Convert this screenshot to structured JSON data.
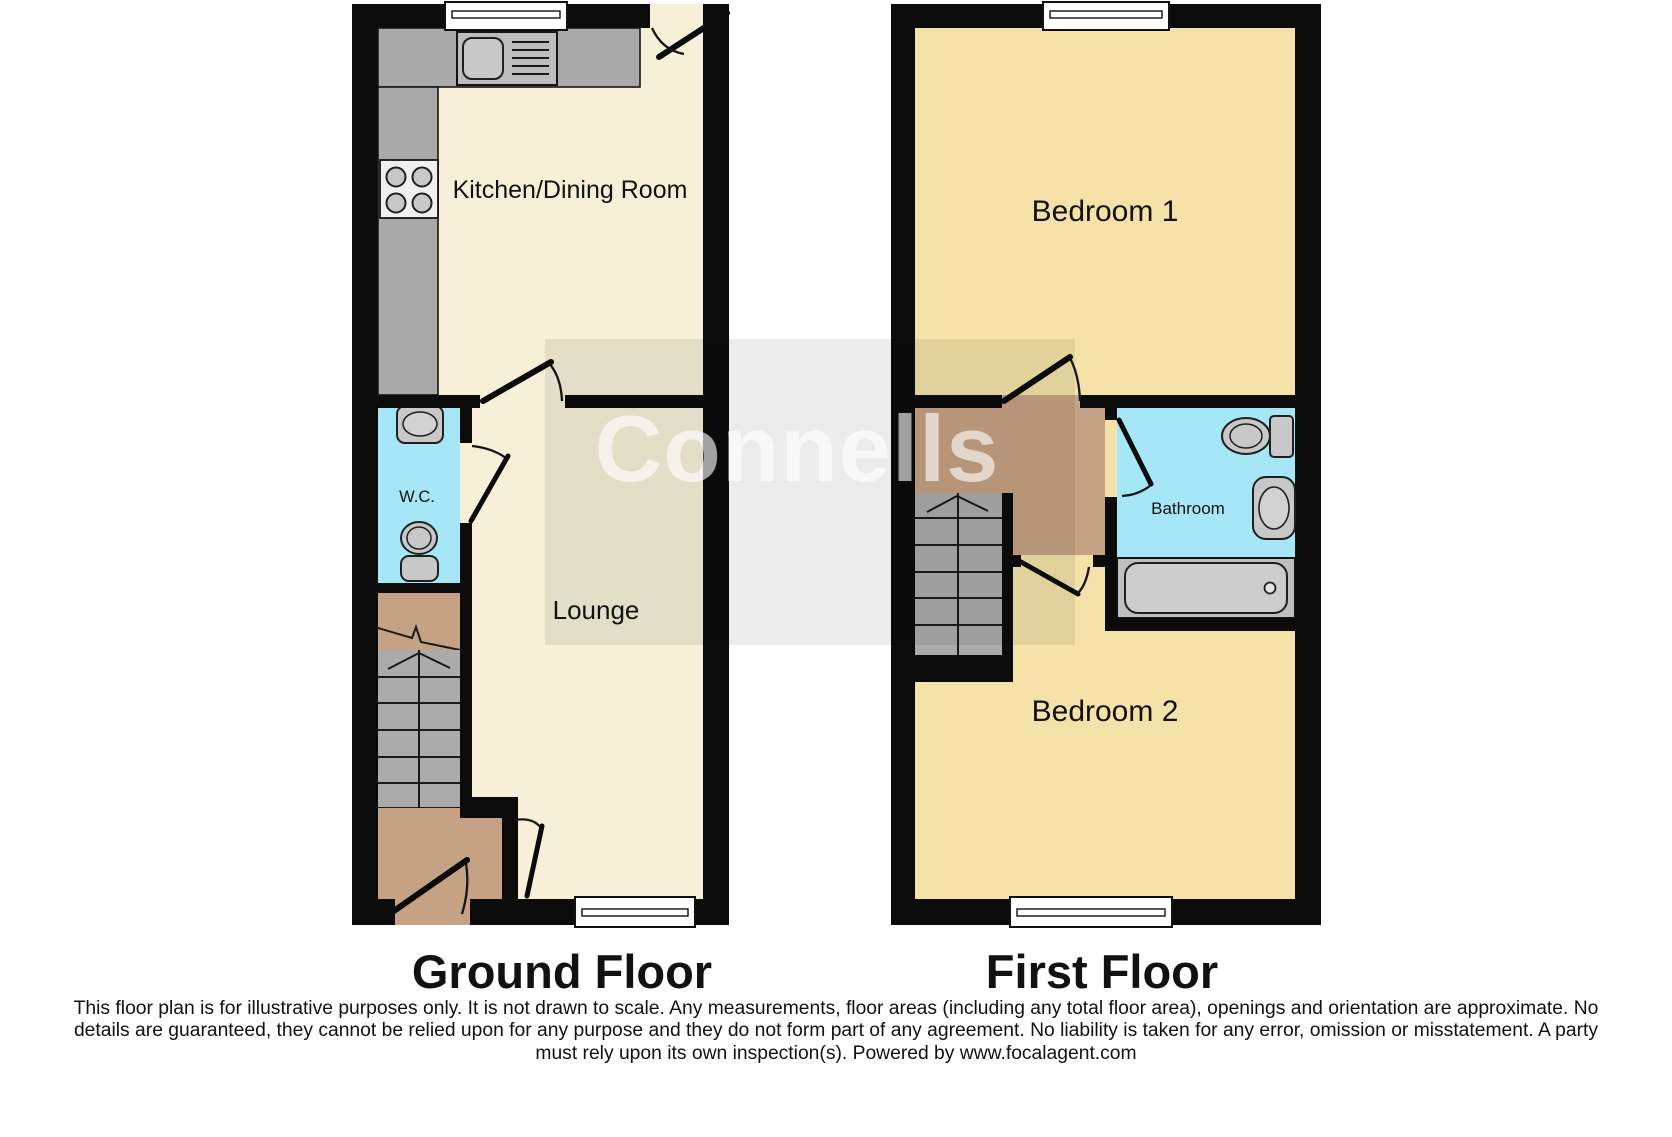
{
  "watermark": {
    "text": "Connells"
  },
  "ground_floor": {
    "label": "Ground Floor",
    "rooms": {
      "kitchen": "Kitchen/Dining Room",
      "wc": "W.C.",
      "lounge": "Lounge"
    }
  },
  "first_floor": {
    "label": "First Floor",
    "rooms": {
      "bedroom1": "Bedroom 1",
      "bathroom": "Bathroom",
      "bedroom2": "Bedroom 2"
    }
  },
  "disclaimer": {
    "line1": "This floor plan is for illustrative purposes only. It is not drawn to scale. Any measurements, floor areas (including any total floor area), openings and orientation are approximate. No",
    "line2": "details are guaranteed, they cannot be relied upon for any purpose and they do not form part of any agreement. No liability is taken for any error, omission or misstatement. A party",
    "line3": "must rely upon its own inspection(s). Powered by www.focalagent.com"
  },
  "icons": {
    "kitchen_sink": "sink-icon",
    "hob": "hob-icon",
    "wc_basin": "basin-icon",
    "wc_toilet": "toilet-icon",
    "bath": "bath-icon",
    "bathroom_toilet": "toilet-icon",
    "bathroom_basin": "basin-icon",
    "stairs": "stairs-icon",
    "window": "window-icon",
    "door": "door-icon"
  },
  "colors": {
    "wall": "#0b0b0b",
    "ground_floor_fill": "#f6f0d8",
    "first_floor_fill": "#f4e2a8",
    "wet_room_fill": "#a5e7f6",
    "landing_fill": "#c5a283",
    "counter_fill": "#a9a9a9",
    "sink_unit_fill": "#bdbdbd",
    "stairs_fill": "#ababab",
    "fixture_fill": "#c8c8c8",
    "bath_surround_fill": "#bfbfbf",
    "bath_fill": "#cdcdcd",
    "hob_fill": "#f0f0f0",
    "window_fill": "#ffffff",
    "watermark_box": "rgba(0,0,0,0.075)",
    "watermark_text": "rgba(255,255,255,0.62)",
    "label_color": "#111111"
  }
}
